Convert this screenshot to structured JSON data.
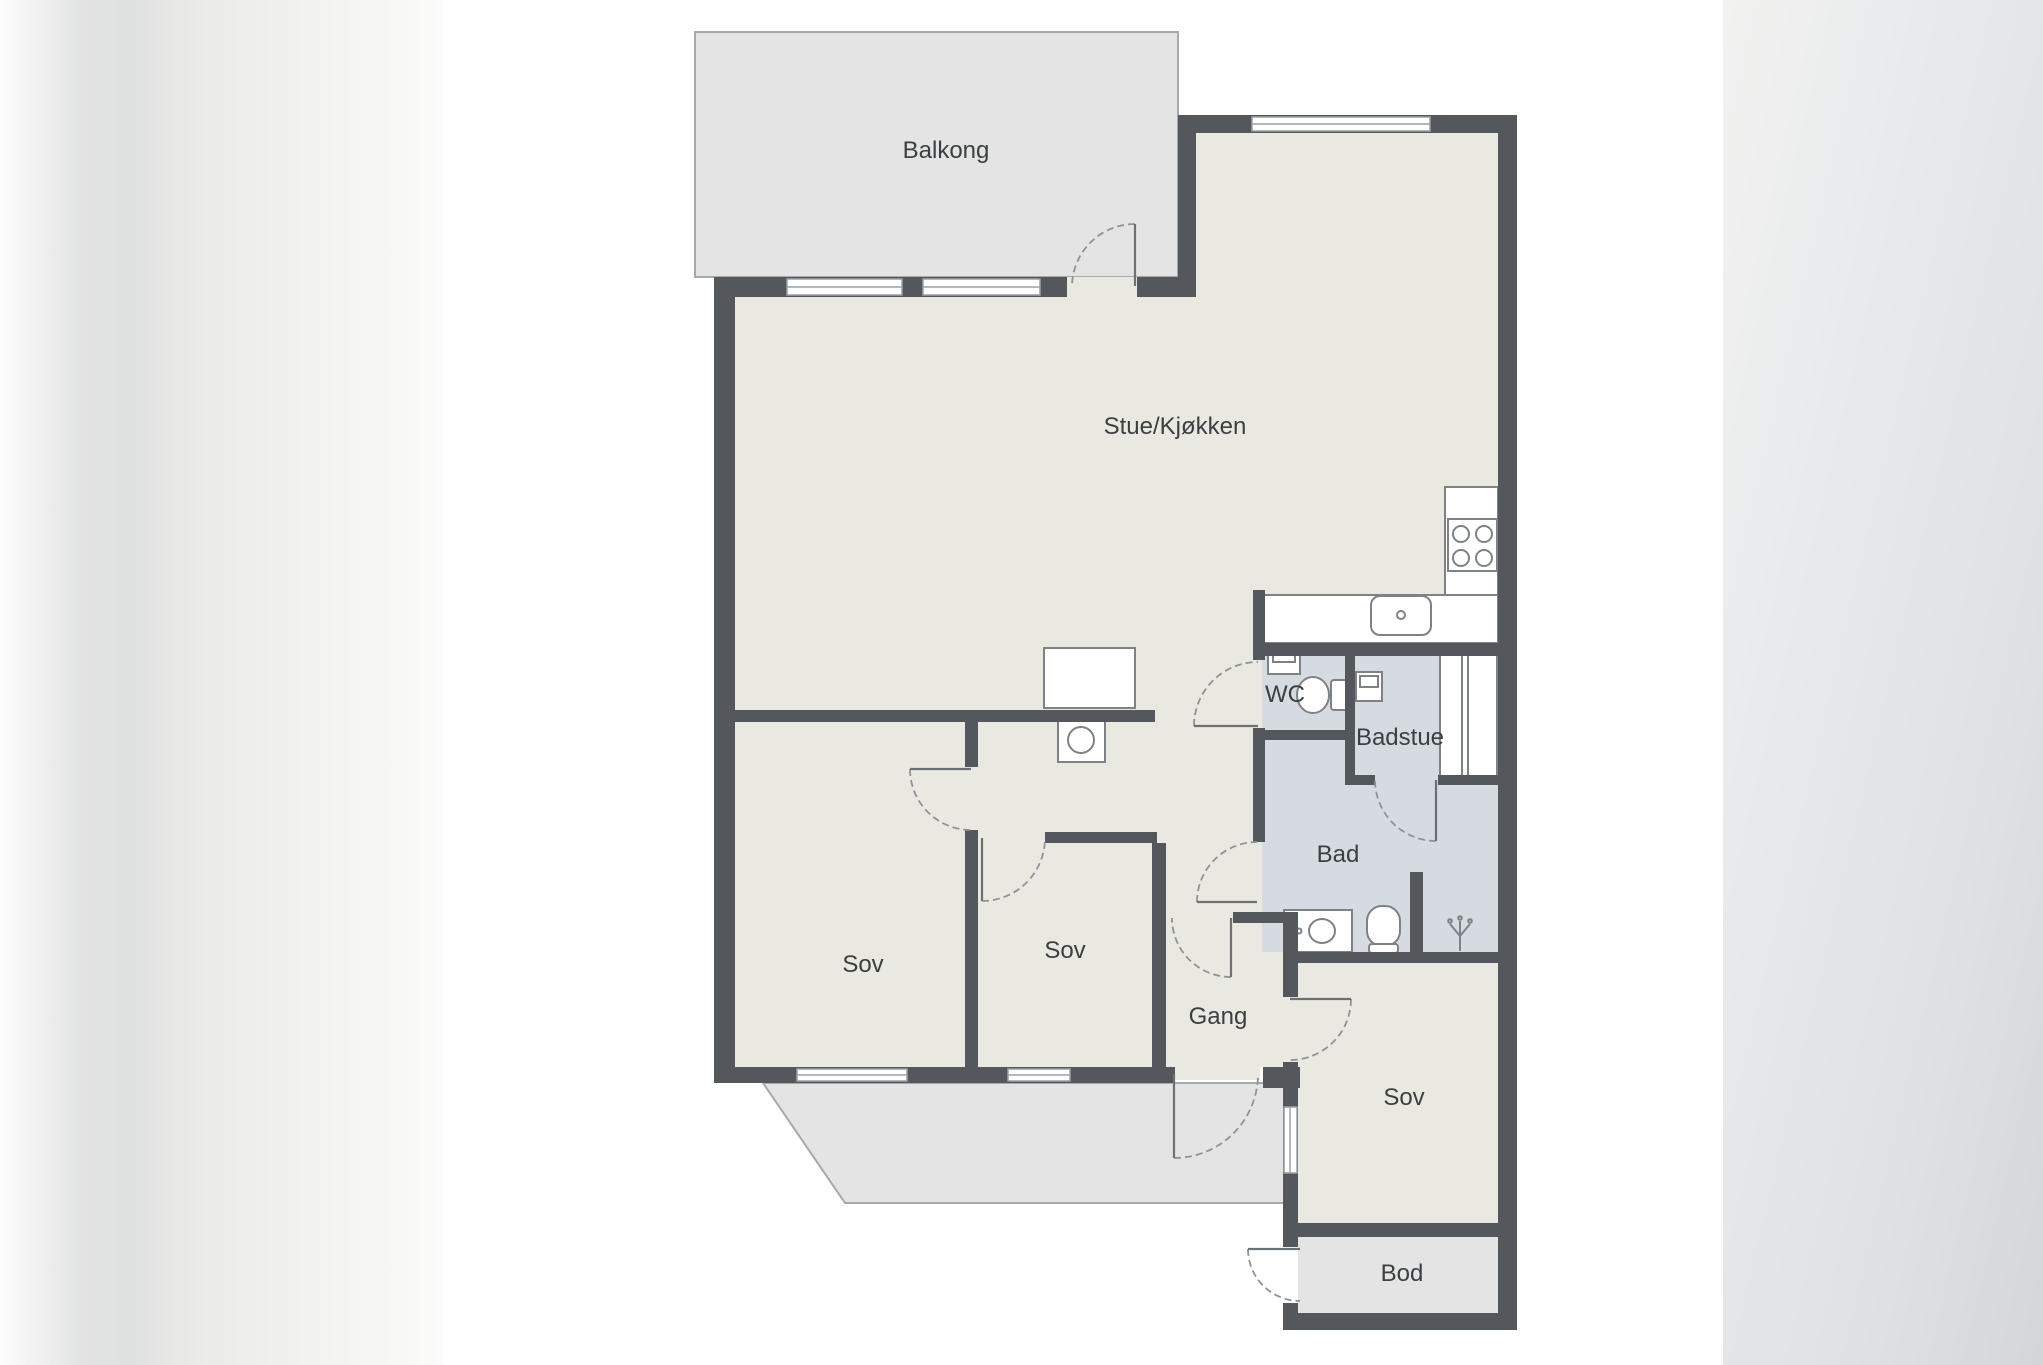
{
  "floorplan": {
    "rooms": {
      "balkong": "Balkong",
      "stue_kjokken": "Stue/Kjøkken",
      "wc": "WC",
      "badstue": "Badstue",
      "bad": "Bad",
      "sov_left": "Sov",
      "sov_mid": "Sov",
      "sov_right": "Sov",
      "gang": "Gang",
      "bod": "Bod"
    },
    "palette": {
      "wall": "#54585c",
      "floor": "#e9e9e1",
      "wet_floor": "#d6dbe2",
      "outdoor": "#e3e4e3",
      "door_arc": "#8f9396",
      "door_leaf": "#6d7174",
      "fixture_stroke": "#7e8284",
      "label_text": "#3c3f41"
    }
  }
}
